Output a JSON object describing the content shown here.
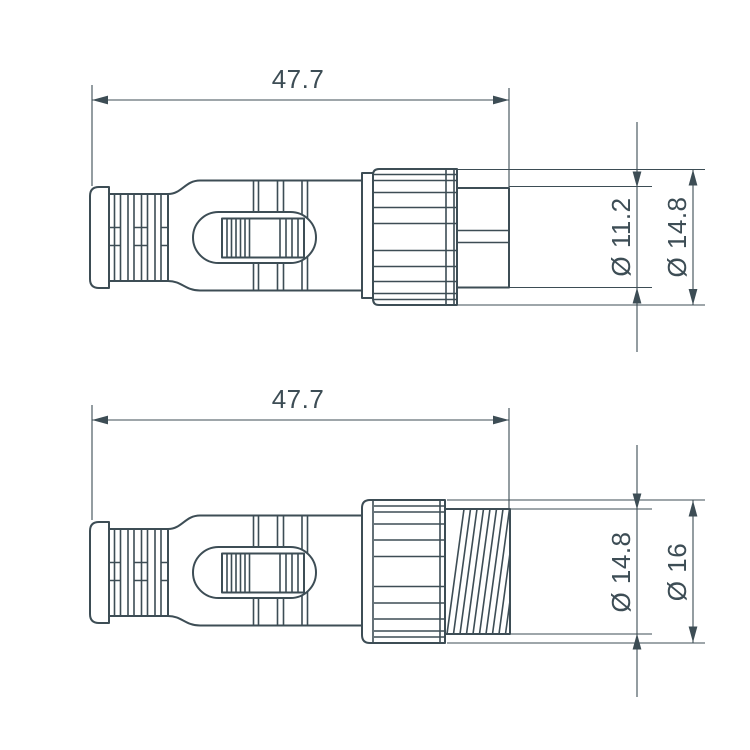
{
  "drawing": {
    "type": "technical-dimension-drawing",
    "colors": {
      "line": "#3d4d55",
      "bg": "#ffffff"
    },
    "views": [
      {
        "name": "connector-plug-side-view-top",
        "length": "47.7",
        "dia_inner": "Ø 11.2",
        "dia_outer": "Ø 14.8"
      },
      {
        "name": "connector-plug-side-view-bottom",
        "length": "47.7",
        "dia_inner": "Ø 14.8",
        "dia_outer": "Ø 16"
      }
    ]
  }
}
